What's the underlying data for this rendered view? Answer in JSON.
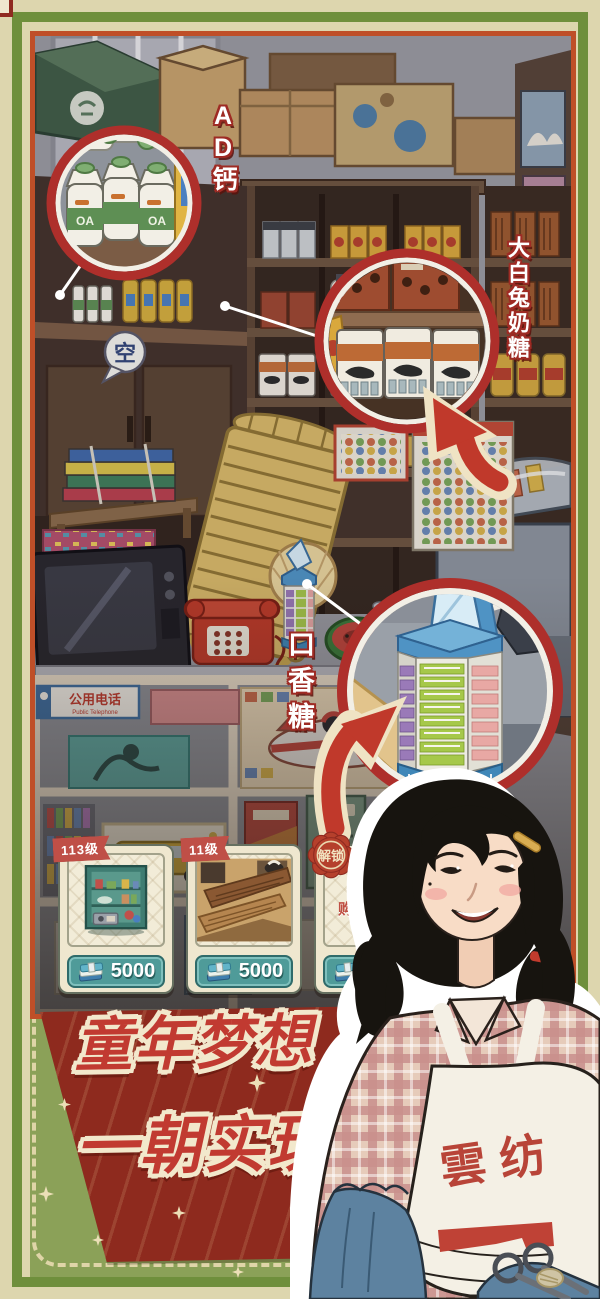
{
  "callouts": {
    "ad_calcium": {
      "label": "AD钙"
    },
    "white_rabbit": {
      "label": "大白兔奶糖"
    },
    "gum": {
      "label": "口香糖"
    }
  },
  "scene": {
    "empty_bubble": "空",
    "phone_sign_cn": "公用电话",
    "phone_sign_en": "Public Telephone",
    "milk_bottle_brand": "OA"
  },
  "cards": [
    {
      "tag": "113级",
      "price": "5000"
    },
    {
      "tag": "11级",
      "price": "5000"
    },
    {
      "tag": "解锁",
      "price": "5000",
      "action": "购买冰箱"
    }
  ],
  "banner": {
    "line1": "童年梦想",
    "line2": "一朝实现"
  },
  "character": {
    "apron_text": "雲纺"
  },
  "colors": {
    "frame_green": "#6f8f3c",
    "photo_border": "#bf4f28",
    "callout_ring": "#ae2f2b",
    "banner_bg": "#8e2a1e",
    "banner_text": "#c13a31",
    "card_bg": "#efe7cf",
    "price_teal": "#4f9b99",
    "section_green": "#8ba158"
  }
}
